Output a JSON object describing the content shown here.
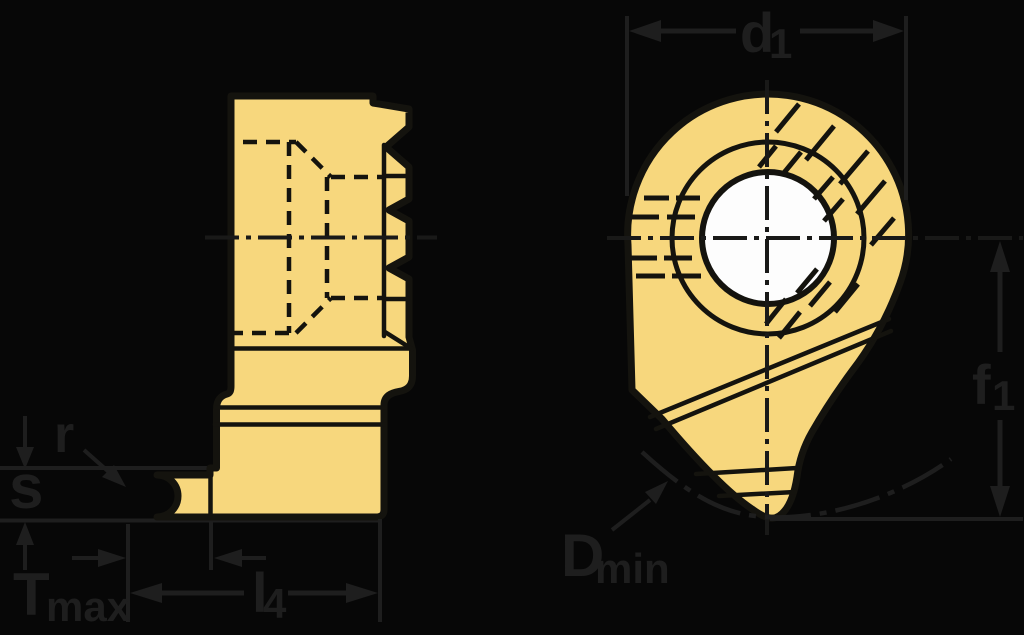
{
  "drawing": {
    "labels": {
      "d1": {
        "base": "d",
        "sub": "1"
      },
      "f1": {
        "base": "f",
        "sub": "1"
      },
      "d_min": {
        "base": "D",
        "sub": "min"
      },
      "t_max": {
        "base": "T",
        "sub": "max"
      },
      "l4": {
        "base": "l",
        "sub": "4"
      },
      "r": "r",
      "s": "s"
    },
    "colors": {
      "background": "#070707",
      "insert_fill": "#f7d77d",
      "insert_outline": "#14130e",
      "annotation": "#1e1e1e",
      "centerline": "#191918",
      "hole_fill": "#fdfdfd"
    }
  }
}
